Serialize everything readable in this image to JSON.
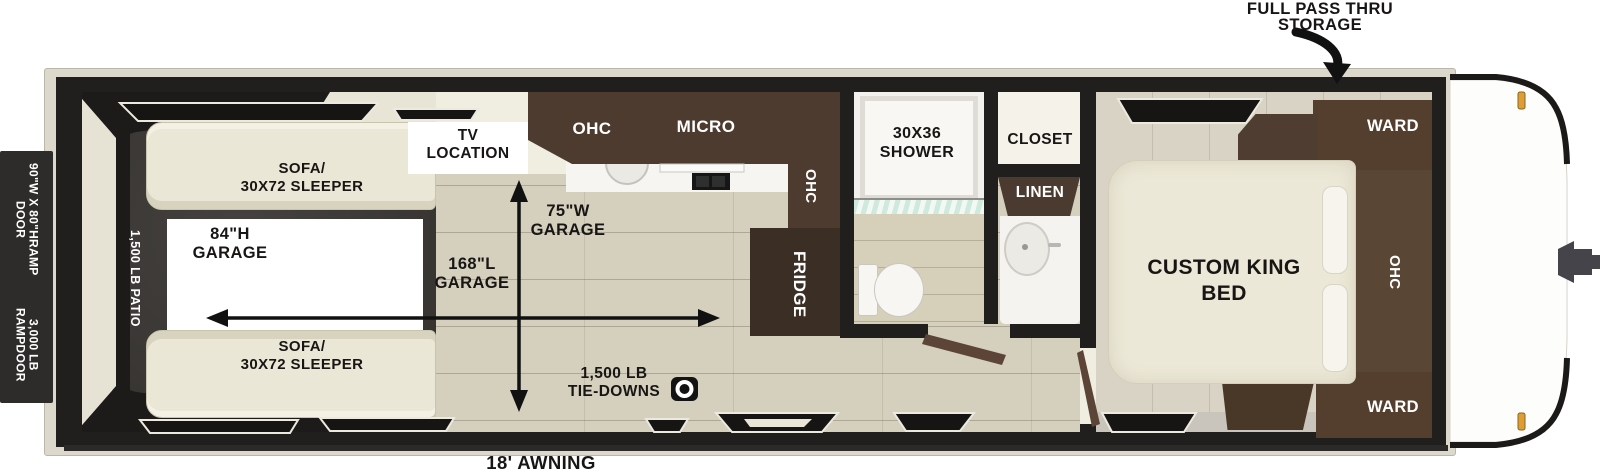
{
  "labels": {
    "pass_thru": [
      "FULL PASS THRU",
      "STORAGE"
    ],
    "ramp_size": [
      "90\"W X 80\"H",
      "RAMP DOOR"
    ],
    "ramp_capacity": [
      "3,000 LB RAMP",
      "DOOR"
    ],
    "patio": "1,500 LB PATIO",
    "sofa": [
      "SOFA/",
      "30X72 SLEEPER"
    ],
    "garage_height": [
      "84\"H",
      "GARAGE"
    ],
    "garage_length": [
      "168\"L",
      "GARAGE"
    ],
    "garage_width": [
      "75\"W",
      "GARAGE"
    ],
    "tv": [
      "TV",
      "LOCATION"
    ],
    "ohc": "OHC",
    "micro": "MICRO",
    "fridge": "FRIDGE",
    "shower": [
      "30X36",
      "SHOWER"
    ],
    "closet": "CLOSET",
    "linen": "LINEN",
    "bed": [
      "CUSTOM KING",
      "BED"
    ],
    "ward": "WARD",
    "tie_downs": [
      "1,500 LB",
      "TIE-DOWNS"
    ],
    "awning": "18' AWNING"
  },
  "icons": {
    "tie_down": "tie-down-ring-icon",
    "storage_arrow": "curved-down-arrow",
    "garage_length_arrow": "horizontal-double-arrow",
    "garage_width_arrow": "vertical-double-arrow"
  },
  "colors": {
    "wall": "#201f1e",
    "frame": "#dcd8cb",
    "interior": "#f0ede1",
    "patio": "#3a3734",
    "wood_floor": "#d5cfbd",
    "cabinet_brown": "#4d3b30",
    "cabinet_dark": "#3b2e25",
    "upholstery_cream": "#ebe7d6",
    "marker_amber": "#dd9f35"
  }
}
